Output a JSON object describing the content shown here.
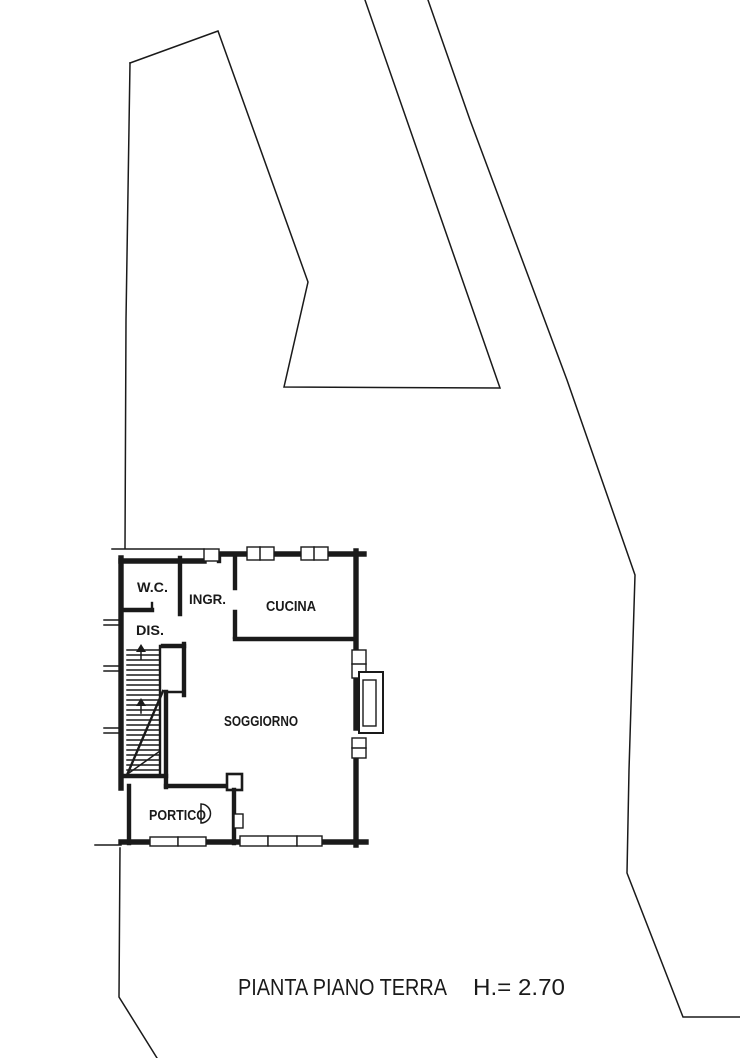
{
  "plan": {
    "rooms": [
      {
        "name": "wc",
        "label": "W.C."
      },
      {
        "name": "ingresso",
        "label": "INGR."
      },
      {
        "name": "cucina",
        "label": "CUCINA"
      },
      {
        "name": "disimpegno",
        "label": "DIS."
      },
      {
        "name": "soggiorno",
        "label": "SOGGIORNO"
      },
      {
        "name": "portico",
        "label": "PORTICO"
      }
    ]
  },
  "caption": {
    "title": "PIANTA PIANO TERRA",
    "height": "H.= 2.70"
  },
  "colors": {
    "ink": "#1a1a1a",
    "paper": "#ffffff"
  }
}
